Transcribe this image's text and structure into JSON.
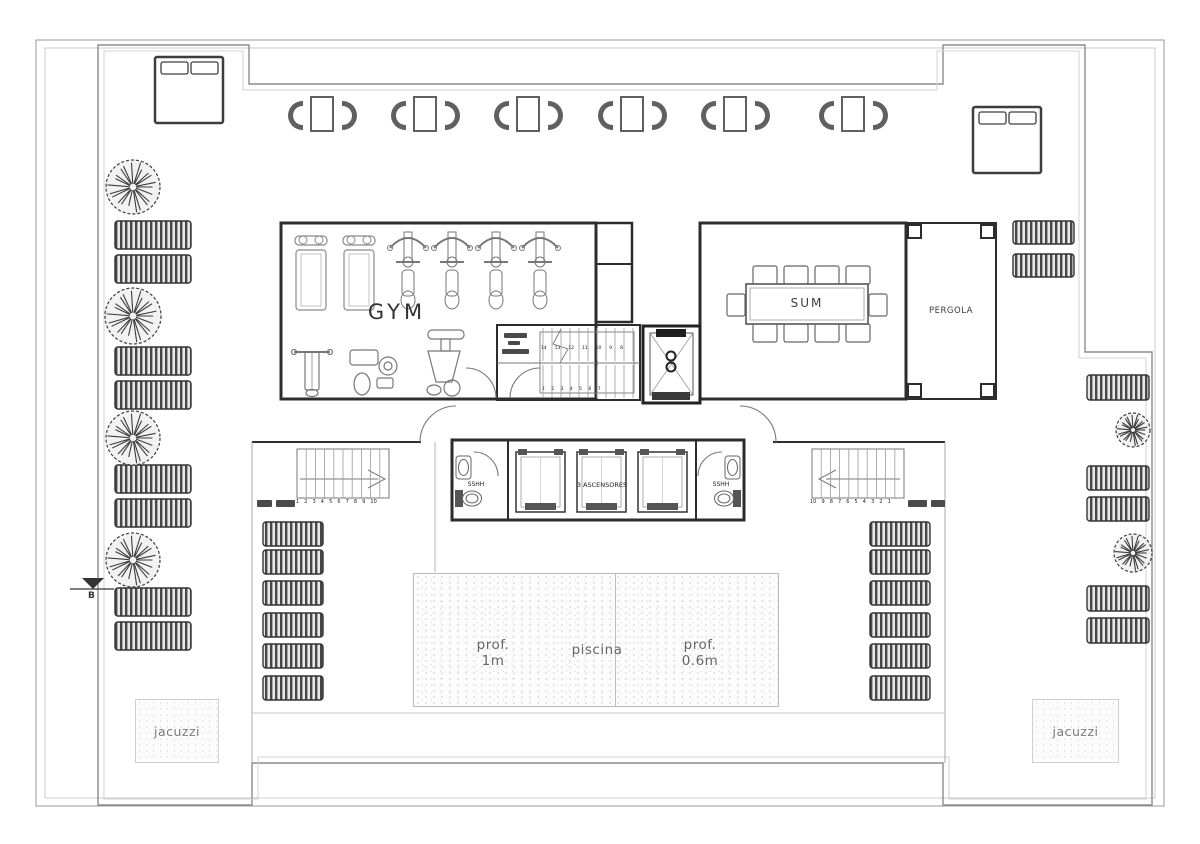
{
  "drawing": {
    "rooms": {
      "gym": "GYM",
      "sum": "SUM",
      "pergola": "PERGOLA"
    },
    "core": {
      "elevators": "3 ASCENSORES",
      "bath_left": "SSHH",
      "bath_right": "SSHH",
      "stair_upper_numbers": "14 13 12 11 10 9 8",
      "stair_lower_numbers": "1 2 3 4 5 6 7"
    },
    "outdoor": {
      "pool_label": "piscina",
      "pool_depth_left_1": "prof.",
      "pool_depth_left_2": "1m",
      "pool_depth_right_1": "prof.",
      "pool_depth_right_2": "0.6m",
      "jacuzzi_left": "jacuzzi",
      "jacuzzi_right": "jacuzzi"
    },
    "stairs": {
      "left_numbers": "1 2 3 4 5 6 7 8 9 10",
      "right_numbers": "10 9 8 7 6 5 4 3 2 1"
    },
    "section_marker": "B"
  }
}
